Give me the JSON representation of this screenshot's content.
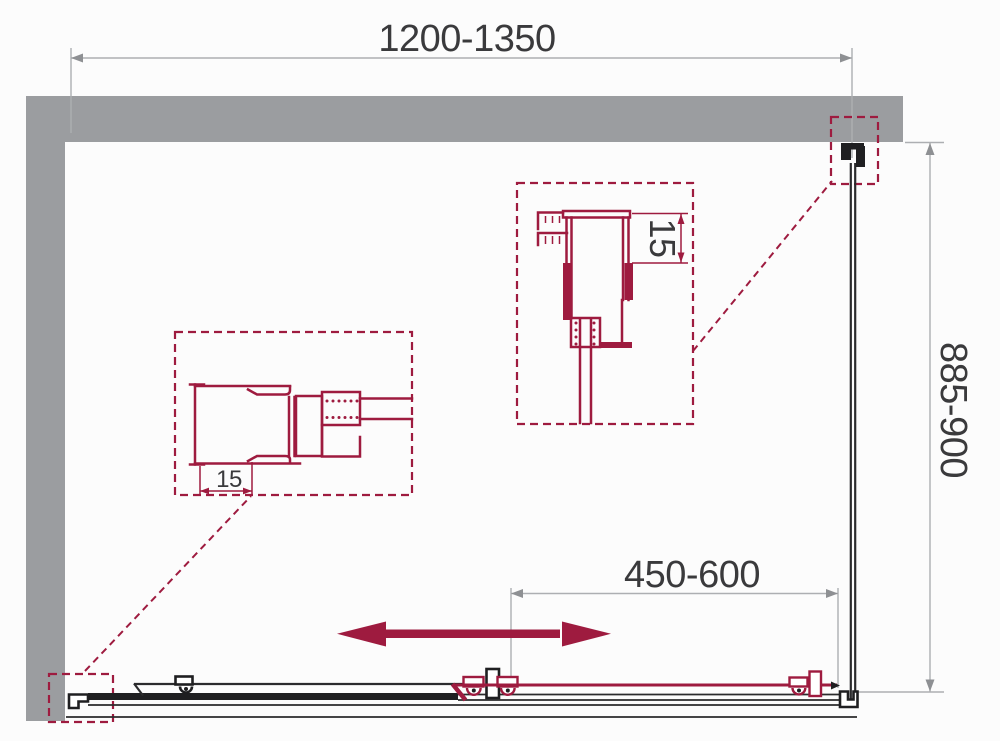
{
  "diagram": {
    "labels": {
      "overall_width": "1200-1350",
      "side_panel_depth": "885-900",
      "sliding_door_width": "450-600",
      "left_profile_adjustment": "15",
      "top_profile_adjustment": "15"
    },
    "colors": {
      "accent": "#9E1B3F",
      "wall": "#9B9DA0",
      "dim_line": "#ADAFB2",
      "dim_arrow": "#8E9093",
      "text": "#3A3A3C",
      "hardware": "#1F1F21",
      "panel": "#2B2B2D"
    }
  }
}
